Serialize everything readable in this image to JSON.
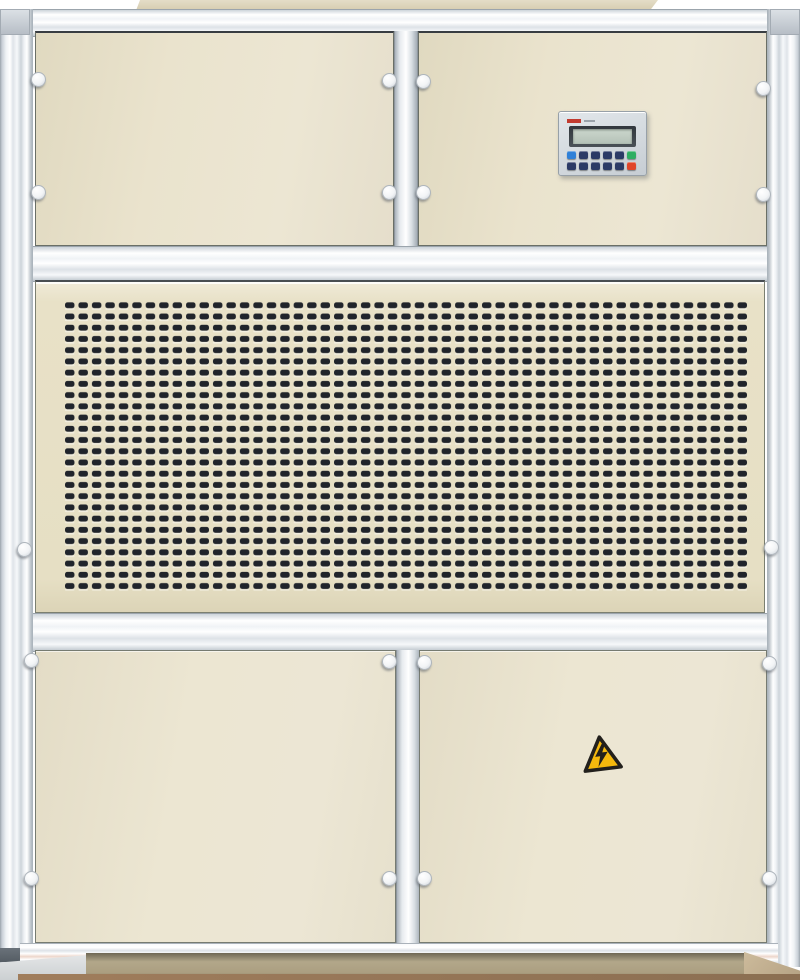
{
  "subject": "beige industrial air-handling cabinet with controller keypad, ventilation grille and high-voltage warning sticker",
  "colors": {
    "background": "#ffffff",
    "panel-beige": "#eae3cd",
    "panel-beige-dark": "#ddd5ba",
    "grille-hole": "#20242b",
    "frame-light": "#f4f6f8",
    "frame-dark": "#aab2ba",
    "bezel-gray": "#d6dce1",
    "lcd-frame": "#3e444b",
    "lcd-screen": "#c3cfc5",
    "btn-navy": "#2b3a66",
    "btn-blue": "#2f80d8",
    "btn-green": "#2fae62",
    "btn-red": "#e0452a",
    "brand-red": "#c23b30",
    "warning-yellow": "#f5b90d",
    "warning-black": "#22201c",
    "plinth-tan": "#b2a78a"
  },
  "control_panel": {
    "lcd_text": "",
    "keypad_rows": [
      [
        "blue",
        "navy",
        "navy",
        "navy",
        "navy",
        "green"
      ],
      [
        "navy",
        "navy",
        "navy",
        "navy",
        "navy",
        "red"
      ]
    ]
  },
  "grille": {
    "columns": 51,
    "rows": 26
  },
  "warning_sticker": {
    "icon": "high-voltage-lightning-icon"
  }
}
